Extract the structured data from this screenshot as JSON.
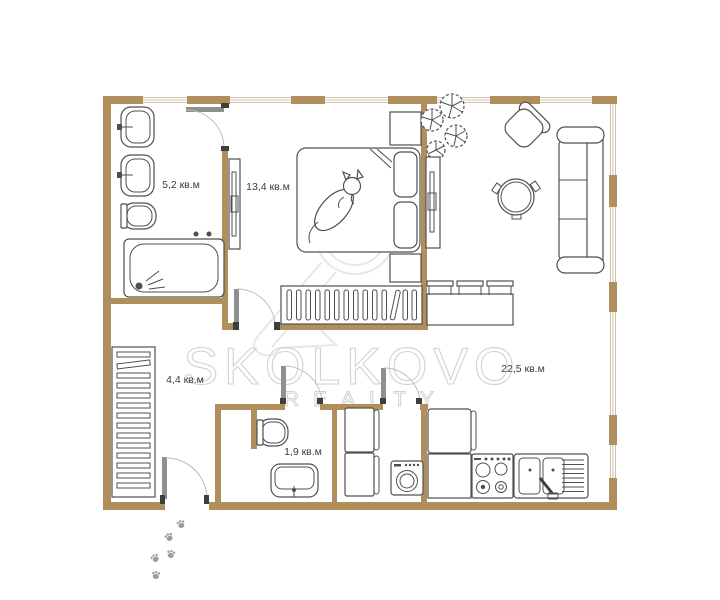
{
  "title": "Apartment floor plan",
  "watermark": {
    "brand": "SKOLKOVO",
    "subtitle": "REALTY"
  },
  "rooms": {
    "bathroom": {
      "area_label": "5,2 кв.м"
    },
    "bedroom": {
      "area_label": "13,4 кв.м"
    },
    "hallway": {
      "area_label": "4,4 кв.м"
    },
    "wc": {
      "area_label": "1,9 кв.м"
    },
    "living_kitchen": {
      "area_label": "22,5 кв.м"
    }
  },
  "colors": {
    "wall": "#b18f5c",
    "window": "#cdc2ae",
    "furniture_stroke": "#4f4f4f",
    "door": "#8f8f8f",
    "watermark": "#d2d2d2",
    "paw": "#9b9b9b",
    "label_text": "#3d3d3d"
  }
}
